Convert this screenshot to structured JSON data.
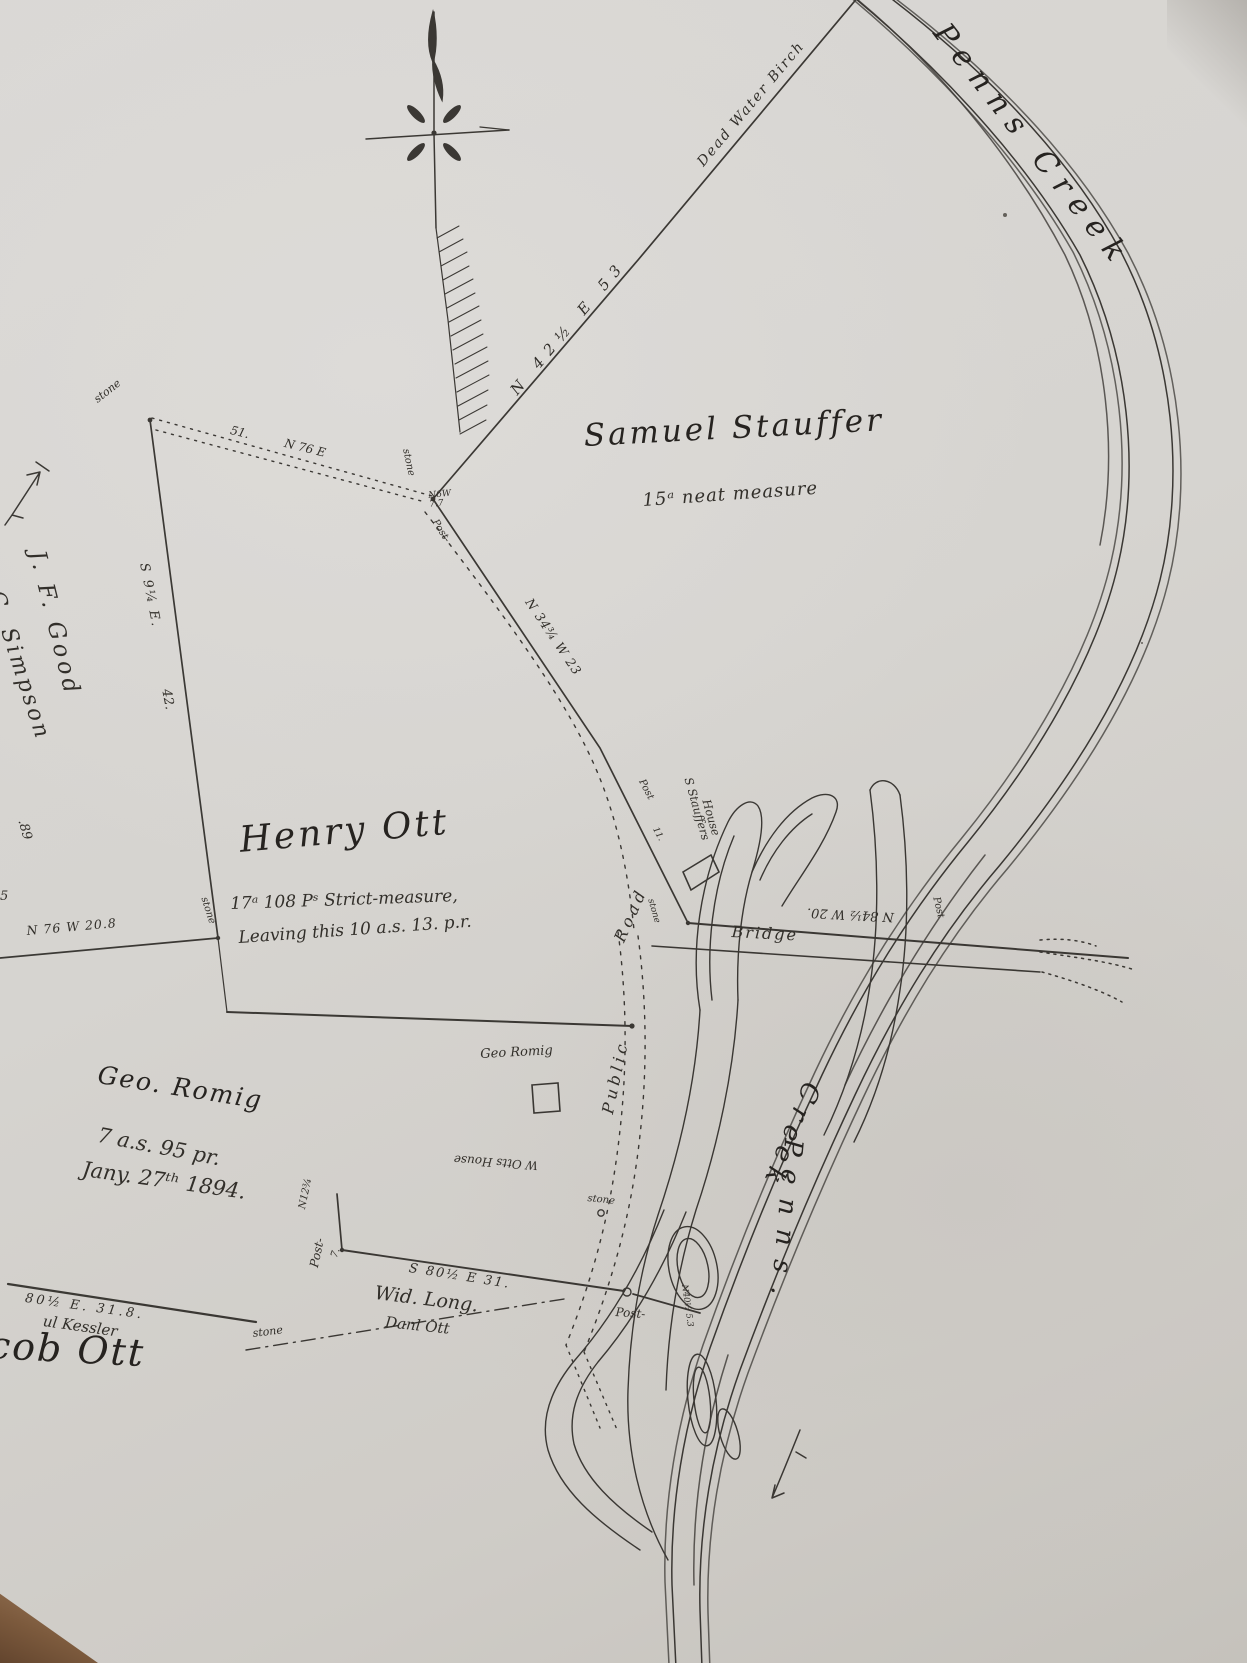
{
  "palette": {
    "paper": "#d6d4d0",
    "ink": "#2e2b27",
    "table": "#7c5a3d"
  },
  "labels": {
    "penns_creek_top": "Penns Creek",
    "creek_bottom": "Creek",
    "penns_bottom": "Penns.",
    "dead_water_birch": "Dead Water Birch",
    "bearing_stauffer_ne": "N 42½ E 53",
    "stauffer_name": "Samuel Stauffer",
    "stauffer_area": "15ᵃ neat measure",
    "stone_nw": "stone",
    "dist_51": "51.",
    "bearing_n76e": "N 76 E",
    "good_name": "J. F. Good",
    "simpson_name": "C. Simpson",
    "simpson_area": ".89",
    "bearing_s914e": "S 9¼ E.",
    "dist_42": "42.",
    "henry_name": "Henry Ott",
    "henry_area": "17ᵃ 108 Pˢ Strict-measure,",
    "henry_note": "Leaving this 10 a.s. 13. p.r.",
    "stone_w": "stone",
    "frag_5": "5",
    "bearing_n76w": "N 76 W 20.8",
    "romig_name": "Geo. Romig",
    "romig_area": "7 a.s. 95 pr.",
    "romig_date": "Jany. 27ᵗʰ 1894.",
    "romig_house": "Geo Romig",
    "otts_house": "W Otts House",
    "bearing_s8012e": "S 80½ E 31.",
    "long_name": "Wid. Long.",
    "long_note": "Danl Ott",
    "post_w": "Post-",
    "bearing_n1234": "N12¾",
    "dist_7": "7.",
    "kessler_bearing": "80½ E.  31.8.",
    "kessler_name": "ul Kessler",
    "jacob_name": "cob Ott",
    "stone_s": "stone",
    "bearing_road": "N 34¾ W 23",
    "post_road_top": "Post-",
    "stone_corner": "stone",
    "corner_bearing": "N6W 7.7",
    "post_road1": "Post",
    "post_road2": "11.",
    "stone_road": "stone",
    "stauffers_house_1": "S Stauffers",
    "stauffers_house_2": "House",
    "bridge": "Bridge",
    "bearing_bridge": "N 84½ W 20.",
    "post_bridge": "Post",
    "stone_creek": "stone",
    "post_creek": "Post-",
    "bearing_small_creek": "N40½ 5.3",
    "road_word_1": "Public",
    "road_word_2": "Road"
  }
}
